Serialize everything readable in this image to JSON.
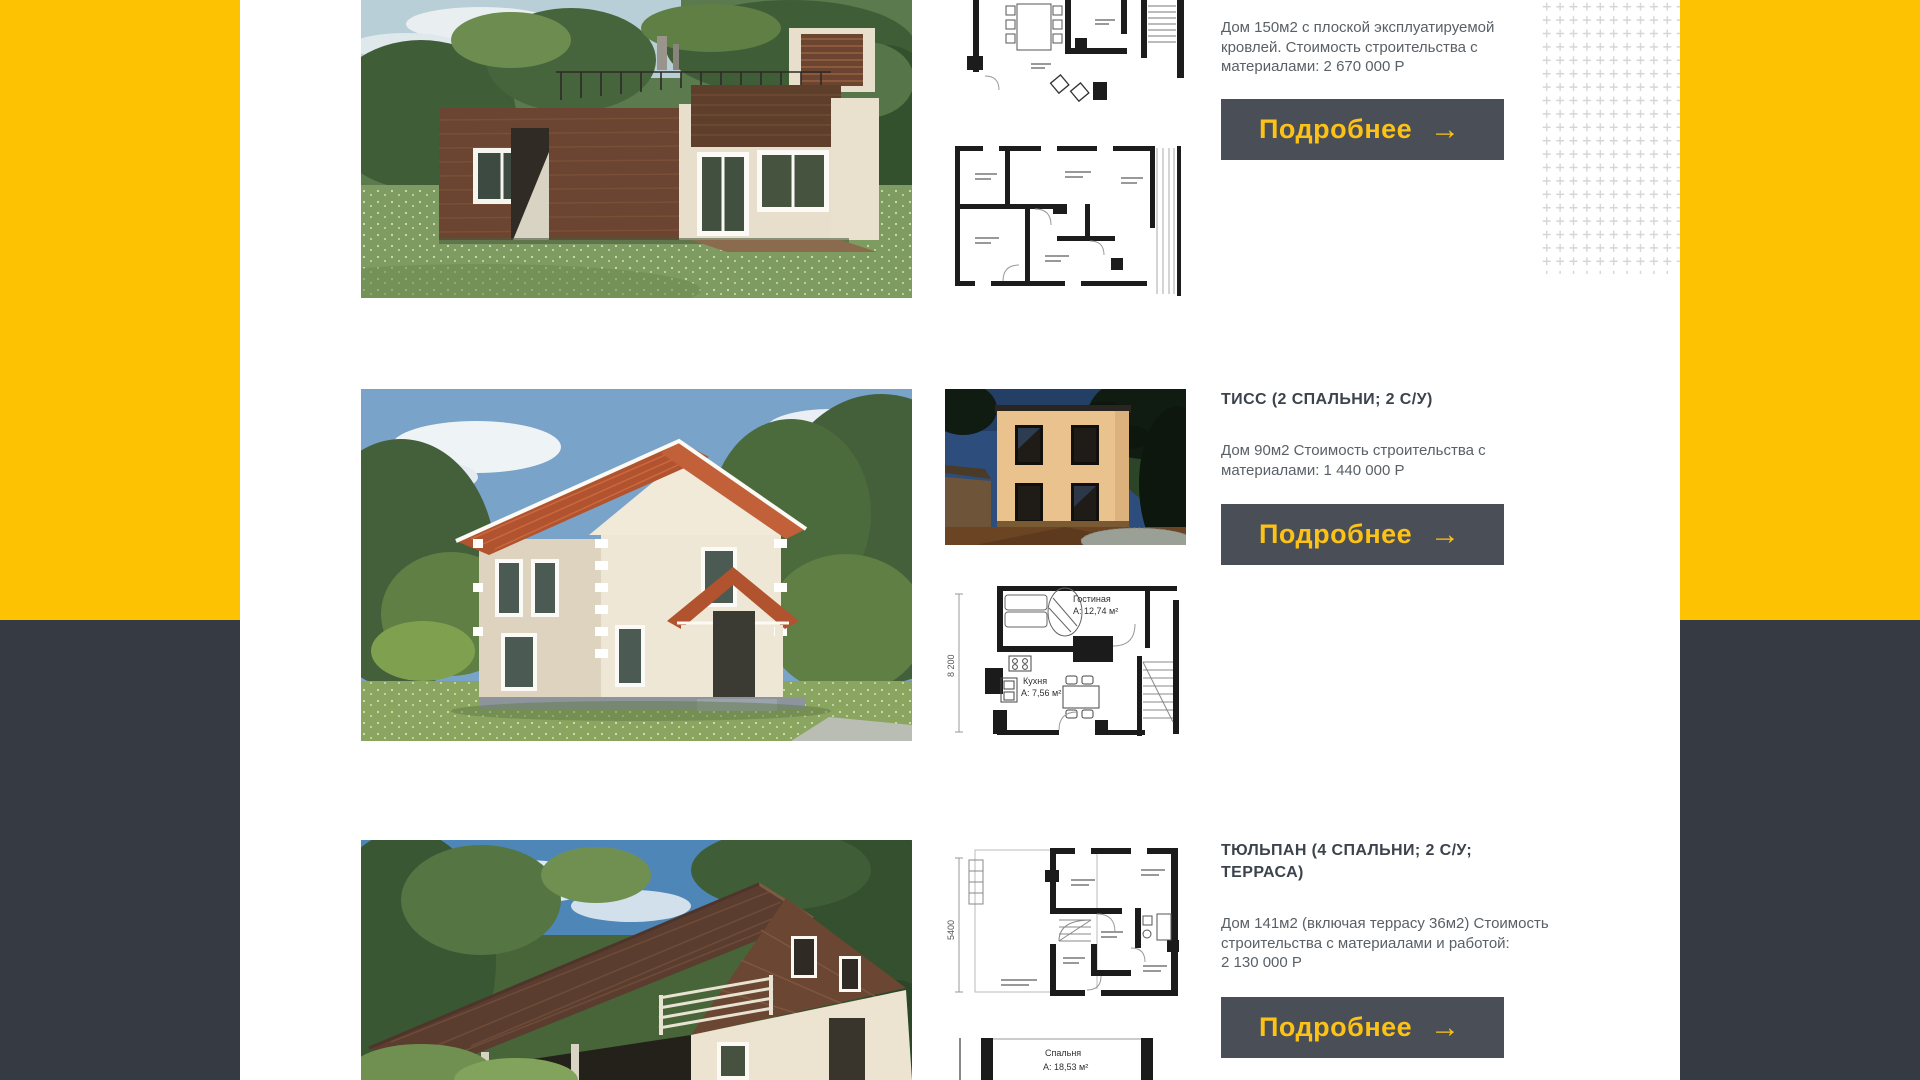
{
  "colors": {
    "accent_yellow": "#fdc303",
    "dark_panel": "#353a43",
    "button_bg": "#4a4e56",
    "button_text": "#fdc216",
    "title_text": "#3c434c",
    "body_text": "#596066",
    "plus_pattern": "#d6d6d9"
  },
  "cards": [
    {
      "description": "Дом 150м2 с плоской эксплуатируемой кровлей. Стоимость строительства с материалами: 2 670 000 Р",
      "description_lines": [
        "Дом 150м2 с плоской эксплуатируемой",
        "кровлей. Стоимость строительства с",
        "материалами: 2 670 000 Р"
      ],
      "button_label": "Подробнее",
      "arrow": "→"
    },
    {
      "title": "ТИСС (2 СПАЛЬНИ; 2 С/У)",
      "description": "Дом 90м2 Стоимость строительства с материалами: 1 440 000 Р",
      "description_lines": [
        "Дом 90м2 Стоимость строительства с",
        "материалами: 1 440 000 Р"
      ],
      "button_label": "Подробнее",
      "arrow": "→",
      "plan": {
        "dim": "8 200",
        "living_room": "Гостиная",
        "living_room_area": "А: 12,74 м²",
        "kitchen": "Кухня",
        "kitchen_area": "А: 7,56 м²"
      }
    },
    {
      "title": "ТЮЛЬПАН (4 СПАЛЬНИ; 2 С/У; ТЕРРАСА)",
      "title_lines": [
        "ТЮЛЬПАН (4 СПАЛЬНИ; 2 С/У;",
        "ТЕРРАСА)"
      ],
      "description": "Дом 141м2 (включая террасу 36м2) Стоимость строительства с материалами и работой: 2 130 000 Р",
      "description_lines": [
        "Дом 141м2 (включая террасу 36м2) Стоимость",
        "строительства с материалами и работой:",
        "2 130 000 Р"
      ],
      "button_label": "Подробнее",
      "arrow": "→",
      "plan": {
        "dim": "5400",
        "bedroom": "Спальня",
        "bedroom_area": "А: 18,53 м²"
      }
    }
  ]
}
